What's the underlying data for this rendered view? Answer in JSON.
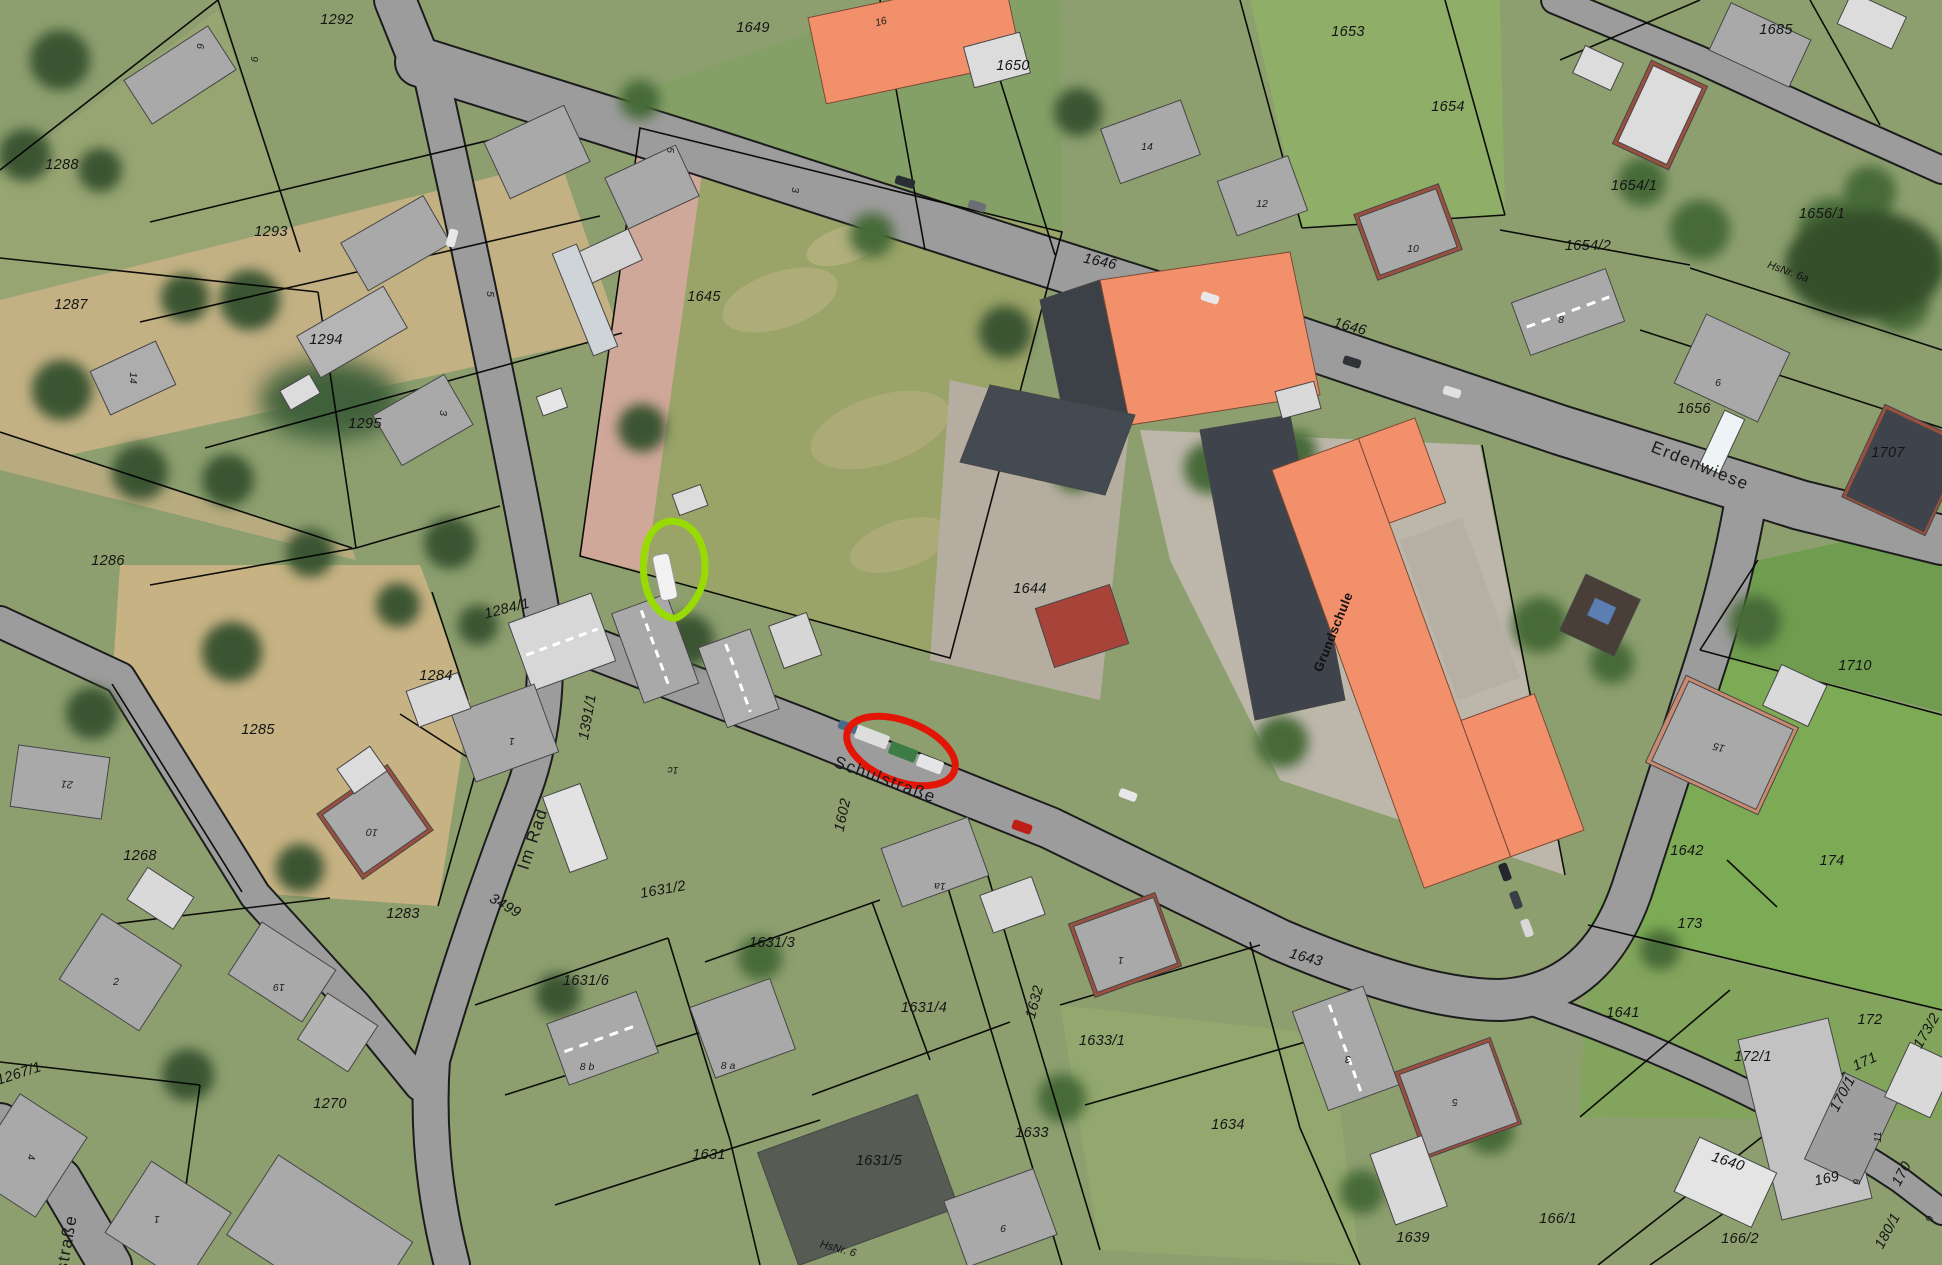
{
  "map": {
    "view": "aerial-orthophoto-with-cadastral-overlay",
    "streets": [
      {
        "text": "Erdenwiese",
        "x": 1700,
        "y": 466,
        "rot": 22
      },
      {
        "text": "Schulstraße",
        "x": 885,
        "y": 780,
        "rot": 20
      },
      {
        "text": "Im Rad",
        "x": 533,
        "y": 839,
        "rot": -72
      },
      {
        "text": "straße",
        "x": 67,
        "y": 1243,
        "rot": -80
      }
    ],
    "building_labels": [
      {
        "text": "Grundschule",
        "x": 1333,
        "y": 632,
        "rot": -68
      }
    ],
    "parcel_labels": [
      {
        "text": "1292",
        "x": 337,
        "y": 20
      },
      {
        "text": "1649",
        "x": 753,
        "y": 28
      },
      {
        "text": "1650",
        "x": 1013,
        "y": 66
      },
      {
        "text": "1653",
        "x": 1348,
        "y": 32
      },
      {
        "text": "1685",
        "x": 1776,
        "y": 30
      },
      {
        "text": "1654",
        "x": 1448,
        "y": 107
      },
      {
        "text": "1288",
        "x": 62,
        "y": 165
      },
      {
        "text": "1654/1",
        "x": 1634,
        "y": 186
      },
      {
        "text": "1293",
        "x": 271,
        "y": 232
      },
      {
        "text": "1287",
        "x": 71,
        "y": 305
      },
      {
        "text": "1654/2",
        "x": 1588,
        "y": 246
      },
      {
        "text": "1656/1",
        "x": 1822,
        "y": 214
      },
      {
        "text": "1294",
        "x": 326,
        "y": 340
      },
      {
        "text": "1295",
        "x": 365,
        "y": 424
      },
      {
        "text": "1646",
        "x": 1100,
        "y": 262,
        "rot": 12
      },
      {
        "text": "1646",
        "x": 1350,
        "y": 327,
        "rot": 15
      },
      {
        "text": "1656",
        "x": 1694,
        "y": 409
      },
      {
        "text": "1707",
        "x": 1888,
        "y": 453
      },
      {
        "text": "1645",
        "x": 704,
        "y": 297
      },
      {
        "text": "1644",
        "x": 1030,
        "y": 589
      },
      {
        "text": "1284/1",
        "x": 507,
        "y": 609,
        "rot": -14
      },
      {
        "text": "1284",
        "x": 436,
        "y": 676
      },
      {
        "text": "1391/1",
        "x": 588,
        "y": 717,
        "rot": -80
      },
      {
        "text": "1285",
        "x": 258,
        "y": 730
      },
      {
        "text": "1286",
        "x": 108,
        "y": 561
      },
      {
        "text": "1268",
        "x": 140,
        "y": 856
      },
      {
        "text": "1283",
        "x": 403,
        "y": 914
      },
      {
        "text": "1267/1",
        "x": 19,
        "y": 1074,
        "rot": -18
      },
      {
        "text": "1270",
        "x": 330,
        "y": 1104
      },
      {
        "text": "3499",
        "x": 505,
        "y": 906,
        "rot": 30
      },
      {
        "text": "1631/2",
        "x": 663,
        "y": 890,
        "rot": -10
      },
      {
        "text": "1631/3",
        "x": 772,
        "y": 943
      },
      {
        "text": "1631/6",
        "x": 586,
        "y": 981
      },
      {
        "text": "1631/4",
        "x": 924,
        "y": 1008
      },
      {
        "text": "1632",
        "x": 1035,
        "y": 1002,
        "rot": -75
      },
      {
        "text": "1633/1",
        "x": 1102,
        "y": 1041
      },
      {
        "text": "1633",
        "x": 1032,
        "y": 1133
      },
      {
        "text": "1631/5",
        "x": 879,
        "y": 1161
      },
      {
        "text": "1631",
        "x": 709,
        "y": 1155
      },
      {
        "text": "1602",
        "x": 843,
        "y": 815,
        "rot": -78
      },
      {
        "text": "1643",
        "x": 1306,
        "y": 958,
        "rot": 15
      },
      {
        "text": "1634",
        "x": 1228,
        "y": 1125
      },
      {
        "text": "1639",
        "x": 1413,
        "y": 1238
      },
      {
        "text": "166/1",
        "x": 1558,
        "y": 1219
      },
      {
        "text": "166/2",
        "x": 1740,
        "y": 1239
      },
      {
        "text": "174",
        "x": 1832,
        "y": 861
      },
      {
        "text": "173",
        "x": 1690,
        "y": 924
      },
      {
        "text": "1641",
        "x": 1623,
        "y": 1013
      },
      {
        "text": "1642",
        "x": 1687,
        "y": 851
      },
      {
        "text": "172",
        "x": 1870,
        "y": 1020
      },
      {
        "text": "172/1",
        "x": 1753,
        "y": 1057
      },
      {
        "text": "171",
        "x": 1865,
        "y": 1062,
        "rot": -25
      },
      {
        "text": "173/2",
        "x": 1927,
        "y": 1031,
        "rot": -60
      },
      {
        "text": "170/1",
        "x": 1843,
        "y": 1094,
        "rot": -62
      },
      {
        "text": "1640",
        "x": 1728,
        "y": 1162,
        "rot": 18
      },
      {
        "text": "169",
        "x": 1827,
        "y": 1179,
        "rot": -12
      },
      {
        "text": "170",
        "x": 1902,
        "y": 1174,
        "rot": -62
      },
      {
        "text": "180/1",
        "x": 1888,
        "y": 1231,
        "rot": -62
      },
      {
        "text": "1710",
        "x": 1855,
        "y": 666
      }
    ],
    "house_numbers": [
      {
        "text": "6",
        "x": 200,
        "y": 46,
        "rot": 90
      },
      {
        "text": "9",
        "x": 254,
        "y": 59,
        "rot": 90
      },
      {
        "text": "5",
        "x": 670,
        "y": 150,
        "rot": 90
      },
      {
        "text": "3",
        "x": 795,
        "y": 190,
        "rot": 90
      },
      {
        "text": "16",
        "x": 881,
        "y": 22,
        "rot": -15
      },
      {
        "text": "14",
        "x": 1147,
        "y": 147
      },
      {
        "text": "12",
        "x": 1262,
        "y": 204
      },
      {
        "text": "10",
        "x": 1413,
        "y": 249
      },
      {
        "text": "8",
        "x": 1561,
        "y": 320
      },
      {
        "text": "14",
        "x": 133,
        "y": 378,
        "rot": 90
      },
      {
        "text": "3",
        "x": 443,
        "y": 413,
        "rot": 90
      },
      {
        "text": "5",
        "x": 490,
        "y": 294,
        "rot": 90
      },
      {
        "text": "6",
        "x": 1718,
        "y": 383
      },
      {
        "text": "HsNr. 6a",
        "x": 1788,
        "y": 272,
        "rot": 20
      },
      {
        "text": "21",
        "x": 67,
        "y": 784,
        "rot": 185
      },
      {
        "text": "10",
        "x": 372,
        "y": 832,
        "rot": 185
      },
      {
        "text": "2",
        "x": 116,
        "y": 982
      },
      {
        "text": "19",
        "x": 279,
        "y": 987,
        "rot": 180
      },
      {
        "text": "4",
        "x": 31,
        "y": 1157,
        "rot": 90
      },
      {
        "text": "1",
        "x": 157,
        "y": 1219,
        "rot": 180
      },
      {
        "text": "1",
        "x": 512,
        "y": 741,
        "rot": 180
      },
      {
        "text": "1c",
        "x": 673,
        "y": 770,
        "rot": 180
      },
      {
        "text": "8 b",
        "x": 587,
        "y": 1067
      },
      {
        "text": "8 a",
        "x": 728,
        "y": 1066
      },
      {
        "text": "1a",
        "x": 940,
        "y": 886,
        "rot": 180
      },
      {
        "text": "1",
        "x": 1121,
        "y": 960,
        "rot": 180
      },
      {
        "text": "6",
        "x": 1003,
        "y": 1229
      },
      {
        "text": "3",
        "x": 1348,
        "y": 1059,
        "rot": 180
      },
      {
        "text": "5",
        "x": 1455,
        "y": 1102,
        "rot": 180
      },
      {
        "text": "15",
        "x": 1719,
        "y": 747,
        "rot": 195
      },
      {
        "text": "11",
        "x": 1878,
        "y": 1137,
        "rot": -90
      },
      {
        "text": "9",
        "x": 1857,
        "y": 1182,
        "rot": -90
      },
      {
        "text": "9",
        "x": 1930,
        "y": 1219,
        "rot": -75
      },
      {
        "text": "HsNr. 6",
        "x": 838,
        "y": 1249,
        "rot": 15
      }
    ],
    "annotations": {
      "green_marker": {
        "shape": "teardrop",
        "color": "#98DB02",
        "cx": 674,
        "cy": 569
      },
      "red_marker": {
        "shape": "ellipse",
        "color": "#E21507",
        "cx": 901,
        "cy": 751,
        "rx": 57,
        "ry": 30,
        "rot": 21
      }
    },
    "colors": {
      "school_building": "#F2906B",
      "building_gray": "#A9A9A9",
      "building_light": "#DCDCDC",
      "road": "#9C9C9C",
      "parcel_line": "#000000",
      "grass": "#8D9F6F",
      "dry_grass": "#C7B283",
      "tree": "#3B5531",
      "annotation_green": "#98DB02",
      "annotation_red": "#E21507"
    }
  }
}
